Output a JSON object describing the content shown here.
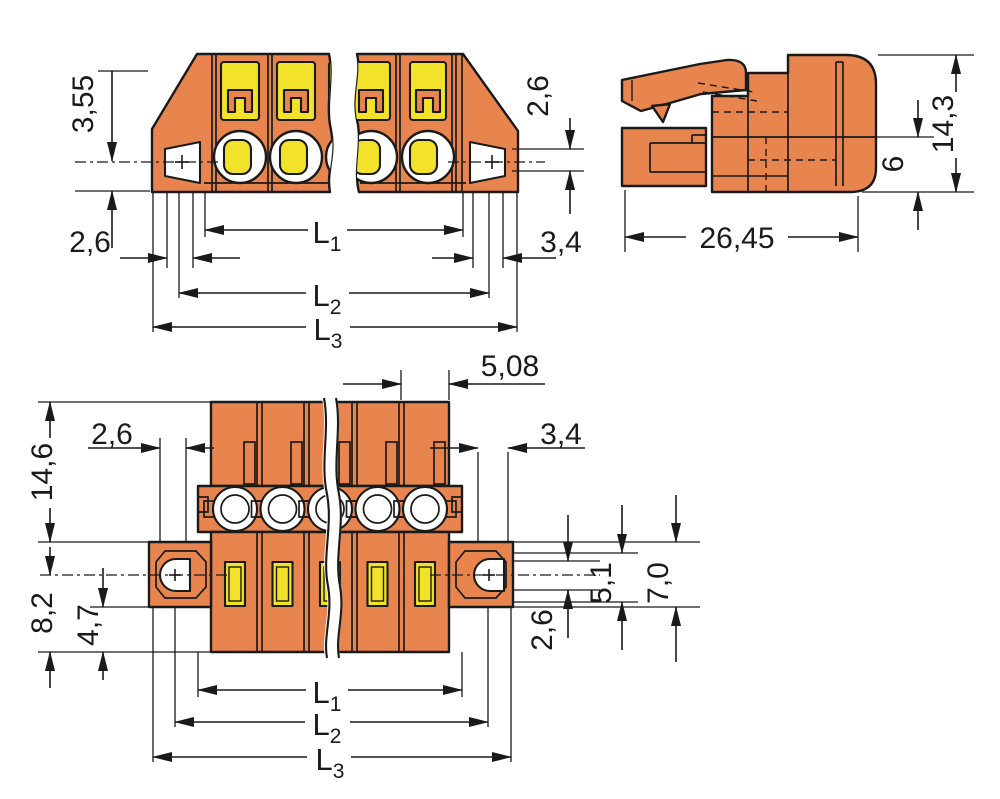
{
  "colors": {
    "body_orange": "#E8854F",
    "contact_yellow": "#F2E32A",
    "line_black": "#1A1A1A",
    "background": "#FFFFFF"
  },
  "front_view": {
    "dim_3_55": "3,55",
    "dim_2_6_bottom_left": "2,6",
    "dim_2_6_right": "2,6",
    "dim_3_4_right": "3,4",
    "dim_l1": {
      "base": "L",
      "sub": "1"
    },
    "dim_l2": {
      "base": "L",
      "sub": "2"
    },
    "dim_l3": {
      "base": "L",
      "sub": "3"
    }
  },
  "side_view": {
    "dim_26_45": "26,45",
    "dim_14_3": "14,3",
    "dim_6": "6"
  },
  "bottom_view": {
    "dim_5_08": "5,08",
    "dim_2_6_top_left": "2,6",
    "dim_3_4_top_right": "3,4",
    "dim_14_6": "14,6",
    "dim_8_2": "8,2",
    "dim_4_7": "4,7",
    "dim_5_1": "5,1",
    "dim_7_0": "7,0",
    "dim_2_6_bottom_right": "2,6",
    "dim_l1": {
      "base": "L",
      "sub": "1"
    },
    "dim_l2": {
      "base": "L",
      "sub": "2"
    },
    "dim_l3": {
      "base": "L",
      "sub": "3"
    }
  }
}
